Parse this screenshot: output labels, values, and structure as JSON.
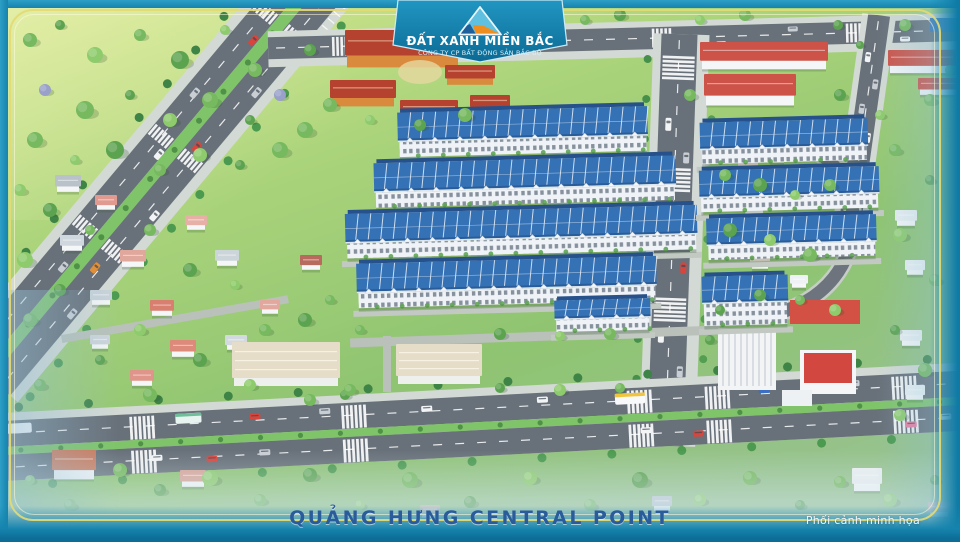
{
  "banner": {
    "brand_title": "ĐẤT XANH MIỀN BẮC",
    "brand_subtitle": "CÔNG TY CP BẤT ĐỘNG SẢN BẮC BỘ",
    "logo_icon": "triangle-mountain-logo-icon"
  },
  "footer": {
    "project_title": "QUẢNG HƯNG CENTRAL POINT",
    "note": "Phối cảnh minh họa"
  },
  "palette": {
    "frame_teal": "#1583ad",
    "frame_line_gold": "#e3da74",
    "banner_teal_top": "#2196c2",
    "banner_teal_bottom": "#0b6a94",
    "logo_light_blue": "#66c5e2",
    "logo_dark_blue": "#1d5f9b",
    "logo_orange": "#ef8d1f",
    "roof_blue": "#3571b5",
    "roof_blue_dark": "#2a5c99",
    "facade_white": "#eff3f7",
    "grass_light": "#dcea92",
    "grass_mid": "#8fc471",
    "asphalt": "#687079",
    "sidewalk": "#d3d9d4",
    "median_green": "#7fc468",
    "red_roof": "#cd5348",
    "resort_roof": "#b5422f",
    "resort_wall": "#d98a3c",
    "title_blue": "#2a5c9c"
  }
}
